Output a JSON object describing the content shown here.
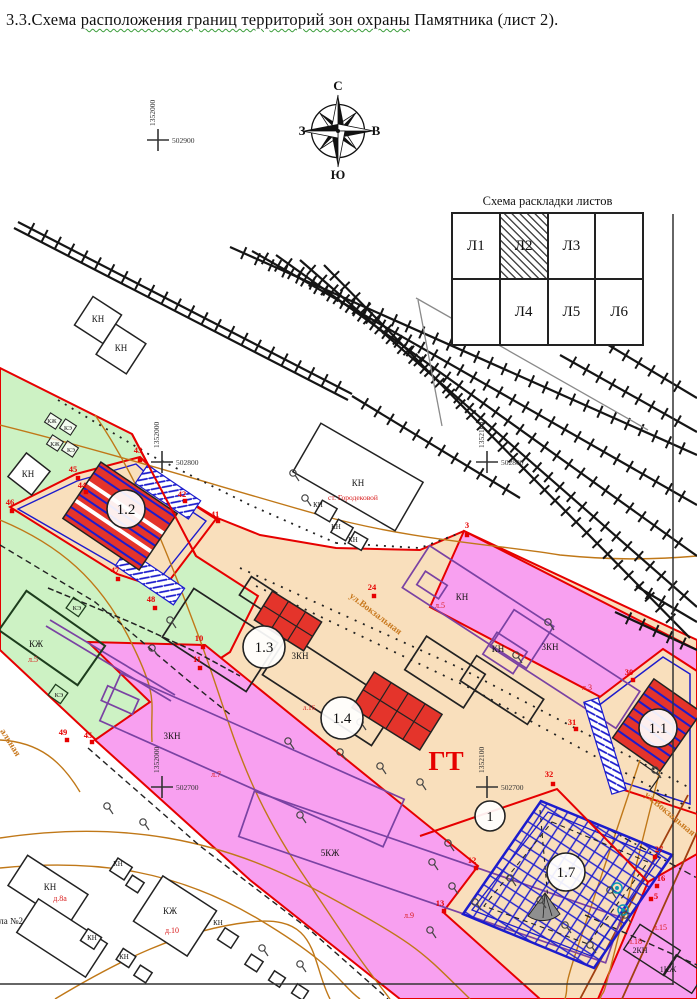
{
  "title": {
    "prefix": "3.3.Схема ",
    "underlined": "расположения границ территорий зон охраны",
    "suffix": " Памятника (лист 2)."
  },
  "compass": {
    "north": "С",
    "south": "Ю",
    "west": "З",
    "east": "В"
  },
  "sheet_layout": {
    "title": "Схема раскладки листов",
    "cells": [
      "Л1",
      "Л2",
      "Л3",
      "",
      "",
      "Л4",
      "Л5",
      "Л6"
    ],
    "hatched_cell": "Л2"
  },
  "coordinate_crosses": [
    {
      "x": 158,
      "y": 140,
      "vertical": "1352000",
      "horizontal": "502900"
    },
    {
      "x": 162,
      "y": 462,
      "vertical": "1352000",
      "horizontal": "502800"
    },
    {
      "x": 487,
      "y": 462,
      "vertical": "1352100",
      "horizontal": "502800"
    },
    {
      "x": 162,
      "y": 787,
      "vertical": "1352000",
      "horizontal": "502700"
    },
    {
      "x": 487,
      "y": 787,
      "vertical": "1352100",
      "horizontal": "502700"
    }
  ],
  "gt_label": {
    "t": "ГТ",
    "x": 446,
    "y": 770
  },
  "station_label": {
    "t": "ст. Городековой",
    "x": 353,
    "y": 500
  },
  "circled_labels": [
    {
      "t": "1.2",
      "x": 126,
      "y": 509,
      "r": 19
    },
    {
      "t": "1.3",
      "x": 264,
      "y": 647,
      "r": 21
    },
    {
      "t": "1.4",
      "x": 342,
      "y": 718,
      "r": 21
    },
    {
      "t": "1.1",
      "x": 658,
      "y": 728,
      "r": 19
    },
    {
      "t": "1.7",
      "x": 566,
      "y": 872,
      "r": 19
    },
    {
      "t": "1",
      "x": 490,
      "y": 816,
      "r": 15
    }
  ],
  "building_labels": [
    {
      "t": "КН",
      "x": 98,
      "y": 322
    },
    {
      "t": "КН",
      "x": 121,
      "y": 351
    },
    {
      "t": "КН",
      "x": 28,
      "y": 477
    },
    {
      "t": "КН",
      "x": 358,
      "y": 486
    },
    {
      "t": "КН",
      "x": 318,
      "y": 507,
      "s": 7
    },
    {
      "t": "КН",
      "x": 336,
      "y": 529,
      "s": 7
    },
    {
      "t": "КН",
      "x": 353,
      "y": 542,
      "s": 7
    },
    {
      "t": "КЖ",
      "x": 36,
      "y": 647
    },
    {
      "t": "КЭ",
      "x": 77,
      "y": 610,
      "s": 6.5
    },
    {
      "t": "КЭ",
      "x": 59,
      "y": 697,
      "s": 6.5
    },
    {
      "t": "КЖ",
      "x": 52,
      "y": 423,
      "s": 6
    },
    {
      "t": "КЭ",
      "x": 68,
      "y": 430,
      "s": 6
    },
    {
      "t": "КЖ",
      "x": 55,
      "y": 446,
      "s": 6
    },
    {
      "t": "КЭ",
      "x": 71,
      "y": 452,
      "s": 6
    },
    {
      "t": "3КН",
      "x": 300,
      "y": 659
    },
    {
      "t": "КН",
      "x": 462,
      "y": 600
    },
    {
      "t": "КН",
      "x": 498,
      "y": 652
    },
    {
      "t": "3КН",
      "x": 550,
      "y": 650
    },
    {
      "t": "3КН",
      "x": 172,
      "y": 739
    },
    {
      "t": "5КЖ",
      "x": 330,
      "y": 856
    },
    {
      "t": "КН",
      "x": 50,
      "y": 890
    },
    {
      "t": "школа №2",
      "x": -16,
      "y": 924,
      "anchor": "start"
    },
    {
      "t": "КЖ",
      "x": 170,
      "y": 914
    },
    {
      "t": "КН",
      "x": 118,
      "y": 866,
      "s": 7
    },
    {
      "t": "КН",
      "x": 92,
      "y": 940,
      "s": 7
    },
    {
      "t": "КН",
      "x": 124,
      "y": 959,
      "s": 7
    },
    {
      "t": "КН",
      "x": 218,
      "y": 925,
      "s": 7
    },
    {
      "t": "2КН",
      "x": 640,
      "y": 953,
      "s": 8
    },
    {
      "t": "1КЖ",
      "x": 668,
      "y": 972,
      "s": 8
    }
  ],
  "lot_labels": [
    {
      "t": "д.8а",
      "x": 60,
      "y": 901
    },
    {
      "t": "д.10",
      "x": 172,
      "y": 933
    },
    {
      "t": "л.5",
      "x": 33,
      "y": 662
    },
    {
      "t": "л.5",
      "x": 440,
      "y": 608
    },
    {
      "t": "л.3",
      "x": 587,
      "y": 690
    },
    {
      "t": "л.7",
      "x": 216,
      "y": 777
    },
    {
      "t": "л.9",
      "x": 409,
      "y": 918
    },
    {
      "t": "л.16",
      "x": 309,
      "y": 710,
      "s": 7
    },
    {
      "t": "л.15",
      "x": 660,
      "y": 930
    },
    {
      "t": "л.18",
      "x": 635,
      "y": 944
    }
  ],
  "vertex_labels": [
    {
      "t": "43",
      "x": 138,
      "y": 453
    },
    {
      "t": "45",
      "x": 73,
      "y": 472
    },
    {
      "t": "44",
      "x": 82,
      "y": 488
    },
    {
      "t": "46",
      "x": 10,
      "y": 505
    },
    {
      "t": "42",
      "x": 182,
      "y": 497
    },
    {
      "t": "41",
      "x": 215,
      "y": 517
    },
    {
      "t": "47",
      "x": 115,
      "y": 573
    },
    {
      "t": "48",
      "x": 151,
      "y": 602
    },
    {
      "t": "10",
      "x": 199,
      "y": 641
    },
    {
      "t": "11",
      "x": 197,
      "y": 662
    },
    {
      "t": "24",
      "x": 372,
      "y": 590
    },
    {
      "t": "3",
      "x": 467,
      "y": 528
    },
    {
      "t": "30",
      "x": 629,
      "y": 675
    },
    {
      "t": "31",
      "x": 572,
      "y": 725
    },
    {
      "t": "32",
      "x": 549,
      "y": 777
    },
    {
      "t": "27",
      "x": 659,
      "y": 852
    },
    {
      "t": "16",
      "x": 661,
      "y": 881
    },
    {
      "t": "5",
      "x": 656,
      "y": 899
    },
    {
      "t": "12",
      "x": 472,
      "y": 863
    },
    {
      "t": "13",
      "x": 440,
      "y": 906
    },
    {
      "t": "49",
      "x": 63,
      "y": 735
    },
    {
      "t": "45",
      "x": 88,
      "y": 738
    }
  ],
  "street_labels": [
    {
      "t": "ул.Вокзальная",
      "x": 374,
      "y": 616,
      "rot": 37
    },
    {
      "t": "ул.Вокзальная",
      "x": 668,
      "y": 816,
      "rot": 40
    },
    {
      "t": "альная",
      "x": 8,
      "y": 744,
      "rot": 58
    }
  ],
  "colors": {
    "zone_green": "#cdf2c4",
    "zone_buffer_tan": "#f9dfbc",
    "zone_pink": "#f8a0f0",
    "boundary_red": "#e60000",
    "hatch_blue": "#1c1ccd",
    "building_red": "#e4342b",
    "contour_orange": "#c07818",
    "street_text_orange": "#c8781e",
    "purple_building": "#7a42a3"
  }
}
